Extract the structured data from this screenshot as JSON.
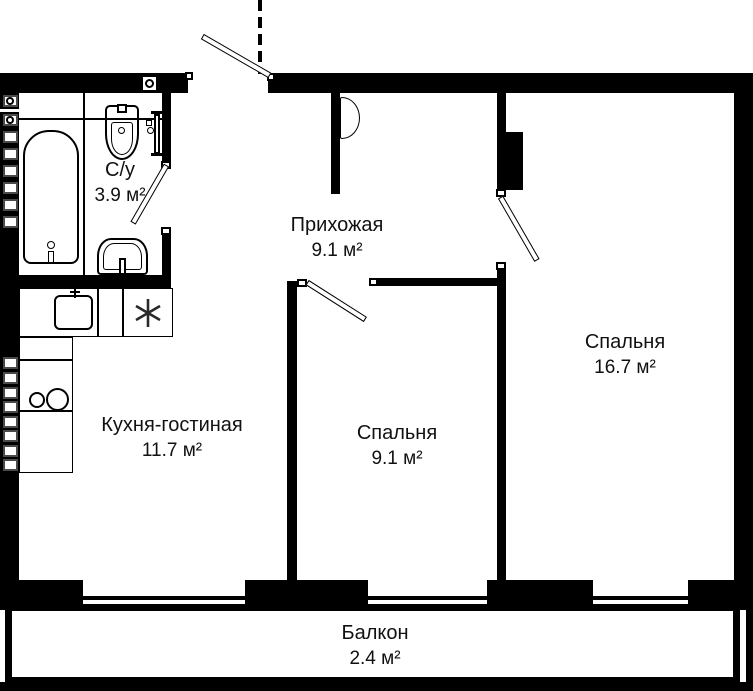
{
  "plan": {
    "type": "apartment-floor-plan",
    "rooms": [
      {
        "id": "bathroom",
        "name": "С/у",
        "area": "3.9 м²"
      },
      {
        "id": "hallway",
        "name": "Прихожая",
        "area": "9.1 м²"
      },
      {
        "id": "bedroom-large",
        "name": "Спальня",
        "area": "16.7 м²"
      },
      {
        "id": "bedroom-small",
        "name": "Спальня",
        "area": "9.1 м²"
      },
      {
        "id": "kitchen-living",
        "name": "Кухня-гостиная",
        "area": "11.7 м²"
      },
      {
        "id": "balcony",
        "name": "Балкон",
        "area": "2.4 м²"
      }
    ],
    "fixtures": {
      "bathroom": [
        "bathtub",
        "toilet",
        "washbasin",
        "towel-rail"
      ],
      "kitchen": [
        "kitchen-sink",
        "fridge-asterisk",
        "hob-two-burners"
      ],
      "walls": [
        "utility-shaft-blocks",
        "vent-box"
      ]
    },
    "doors": [
      "entrance-door",
      "bathroom-door",
      "bedroom-small-door",
      "bedroom-large-door"
    ],
    "windows_count": 3,
    "colors": {
      "wall": "#000000",
      "background": "#ffffff",
      "text": "#111111",
      "shaft_border": "#4a4a4a"
    }
  }
}
